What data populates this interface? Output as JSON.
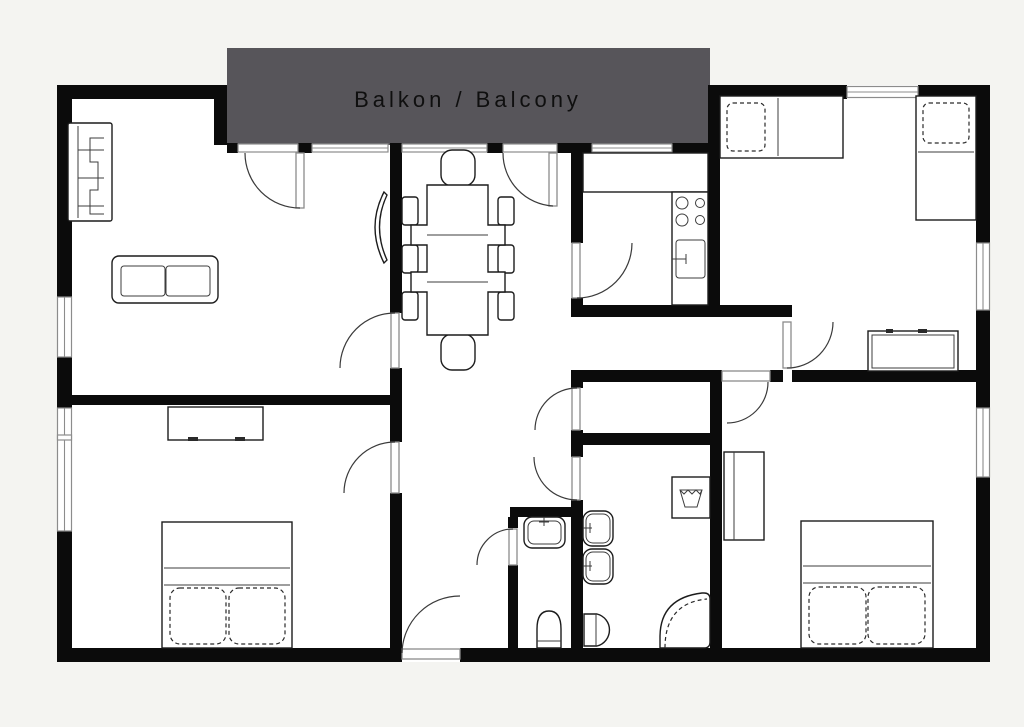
{
  "balcony": {
    "label": "Balkon / Balcony"
  },
  "colors": {
    "background": "#f4f4f1",
    "floor": "#ffffff",
    "wall": "#0b0b0b",
    "balcony_fill": "#57555a",
    "window_frame": "#8c8c8c",
    "door_line": "#3a3a3a",
    "furniture_line": "#1c1c1c",
    "label_text": "#0f0f0f"
  },
  "icons": {
    "furniture_symbols": [
      "wardrobe-icon",
      "sofa-icon",
      "tv-icon",
      "dining-table-icon",
      "dining-chair-icon",
      "kitchen-counter-icon",
      "stove-icon",
      "kitchen-sink-icon",
      "single-bed-icon",
      "double-bed-icon",
      "dresser-icon",
      "washing-machine-icon",
      "bathroom-sink-icon",
      "toilet-icon",
      "corner-bathtub-icon",
      "door-swing-icon",
      "window-icon"
    ]
  }
}
